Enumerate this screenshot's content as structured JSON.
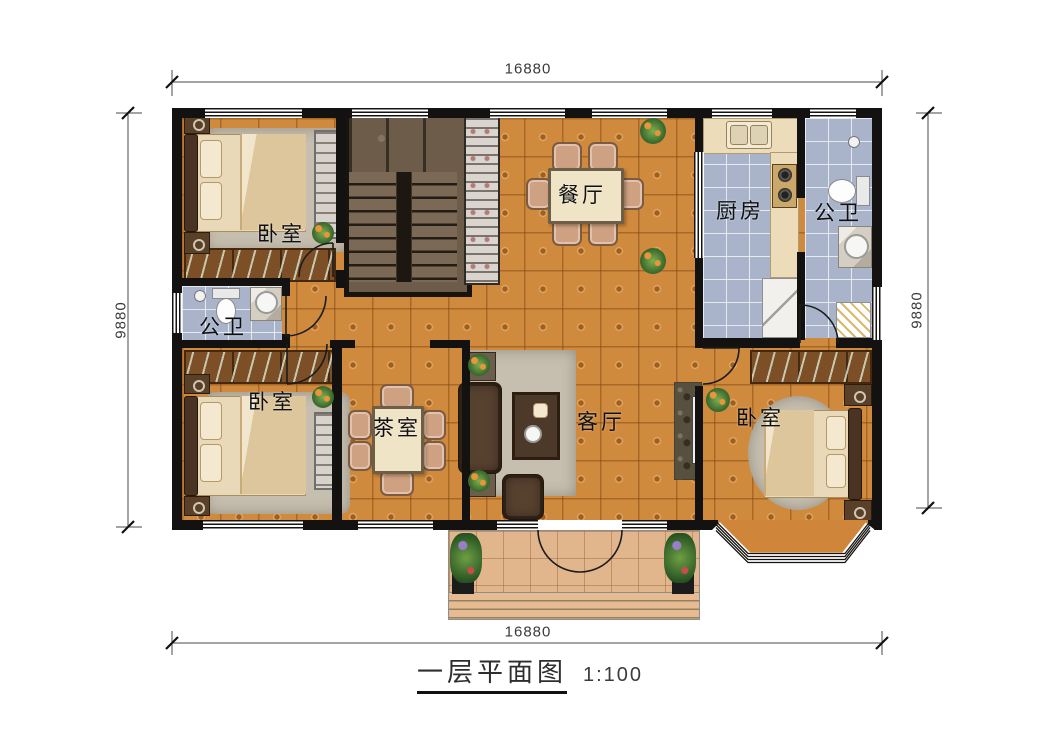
{
  "title": {
    "name": "一层平面图",
    "scale": "1:100"
  },
  "dimensions": {
    "top": "16880",
    "bottom": "16880",
    "left": "9880",
    "right": "9880"
  },
  "rooms": {
    "bedroom_top_left": "卧室",
    "dining": "餐厅",
    "kitchen": "厨房",
    "bath_top_right": "公卫",
    "bath_left": "公卫",
    "bedroom_bottom_left": "卧室",
    "tea_room": "茶室",
    "living": "客厅",
    "bedroom_bottom_right": "卧室"
  },
  "colors": {
    "wall": "#141210",
    "floor-main": "#d08a3e",
    "floor-wet": "#a9b4cb",
    "floor-porch": "#e2b68c",
    "stair": "#6e5c4a",
    "wood": "#7c4f27",
    "counter": "#ecdcba",
    "rug": "#c6bfb0",
    "sofa": "#57412f",
    "fabric": "#ead9b8"
  }
}
